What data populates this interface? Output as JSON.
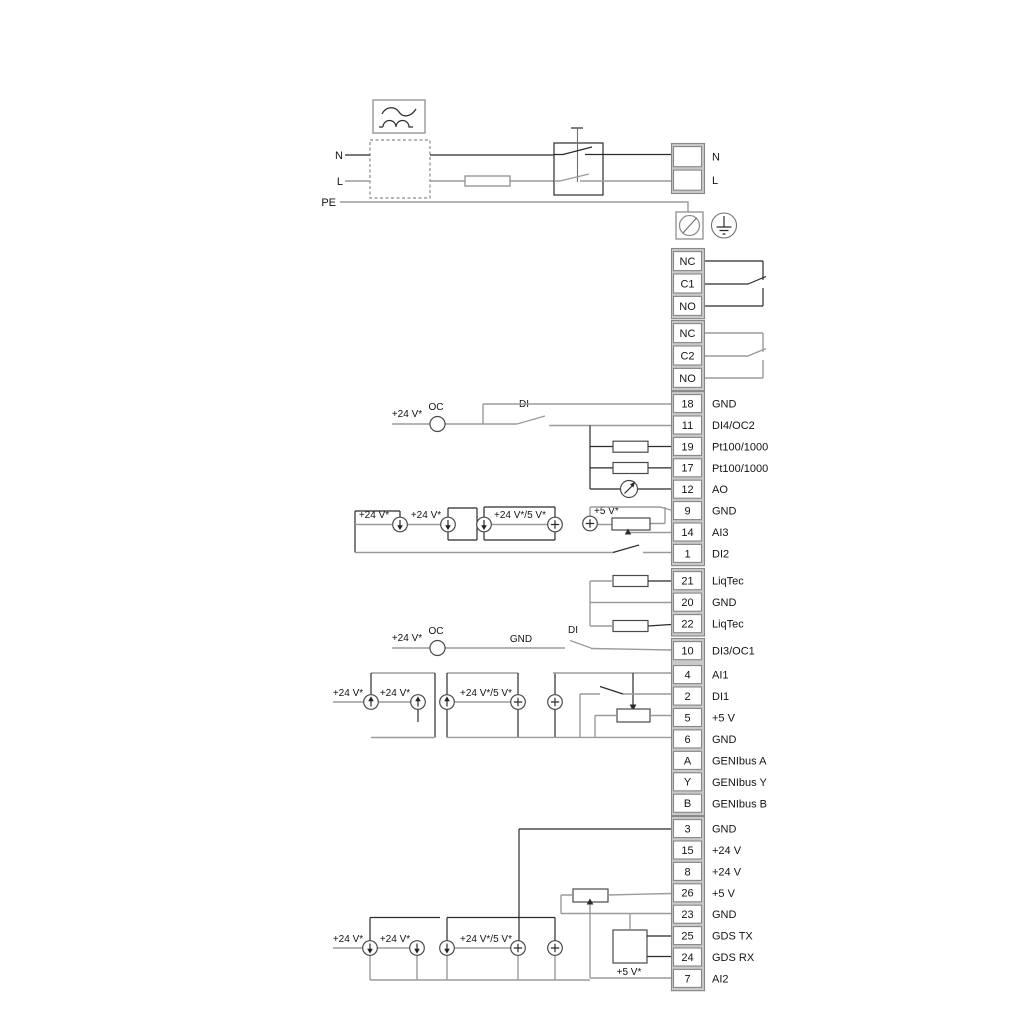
{
  "title": "pump-electrical-wiring-diagram",
  "colors": {
    "wire_gray": "#9b9b9b",
    "wire_dark": "#2b2b2b",
    "terminal_border": "#878787",
    "terminal_fill": "#c9c9c9"
  },
  "power": {
    "n_left": "N",
    "l_left": "L",
    "pe": "PE"
  },
  "annotations": {
    "v24": "+24 V*",
    "v24_5": "+24 V*/5 V*",
    "v5": "+5 V*",
    "oc": "OC",
    "di": "DI",
    "gnd": "GND"
  },
  "terminal_groups": [
    {
      "name": "power-nl",
      "cells": [
        {
          "num": "",
          "label": "N"
        },
        {
          "num": "",
          "label": "L"
        }
      ]
    },
    {
      "name": "relay-1",
      "cells": [
        {
          "num": "NC",
          "label": ""
        },
        {
          "num": "C1",
          "label": ""
        },
        {
          "num": "NO",
          "label": ""
        }
      ]
    },
    {
      "name": "relay-2",
      "cells": [
        {
          "num": "NC",
          "label": ""
        },
        {
          "num": "C2",
          "label": ""
        },
        {
          "num": "NO",
          "label": ""
        }
      ]
    },
    {
      "name": "io-top",
      "cells": [
        {
          "num": "18",
          "label": "GND"
        },
        {
          "num": "11",
          "label": "DI4/OC2"
        },
        {
          "num": "19",
          "label": "Pt100/1000"
        },
        {
          "num": "17",
          "label": "Pt100/1000"
        },
        {
          "num": "12",
          "label": "AO"
        },
        {
          "num": "9",
          "label": "GND"
        },
        {
          "num": "14",
          "label": "AI3"
        },
        {
          "num": "1",
          "label": "DI2"
        }
      ]
    },
    {
      "name": "liqtec",
      "cells": [
        {
          "num": "21",
          "label": "LiqTec"
        },
        {
          "num": "20",
          "label": "GND"
        },
        {
          "num": "22",
          "label": "LiqTec"
        }
      ]
    },
    {
      "name": "io-mid",
      "cells": [
        {
          "num": "10",
          "label": "DI3/OC1"
        },
        {
          "num": "4",
          "label": "AI1"
        },
        {
          "num": "2",
          "label": "DI1"
        },
        {
          "num": "5",
          "label": "+5 V"
        },
        {
          "num": "6",
          "label": "GND"
        },
        {
          "num": "A",
          "label": "GENIbus A"
        },
        {
          "num": "Y",
          "label": "GENIbus Y"
        },
        {
          "num": "B",
          "label": "GENIbus B"
        }
      ]
    },
    {
      "name": "io-bottom",
      "cells": [
        {
          "num": "3",
          "label": "GND"
        },
        {
          "num": "15",
          "label": "+24 V"
        },
        {
          "num": "8",
          "label": "+24 V"
        },
        {
          "num": "26",
          "label": "+5 V"
        },
        {
          "num": "23",
          "label": "GND"
        },
        {
          "num": "25",
          "label": "GDS TX"
        },
        {
          "num": "24",
          "label": "GDS RX"
        },
        {
          "num": "7",
          "label": "AI2"
        }
      ]
    }
  ]
}
